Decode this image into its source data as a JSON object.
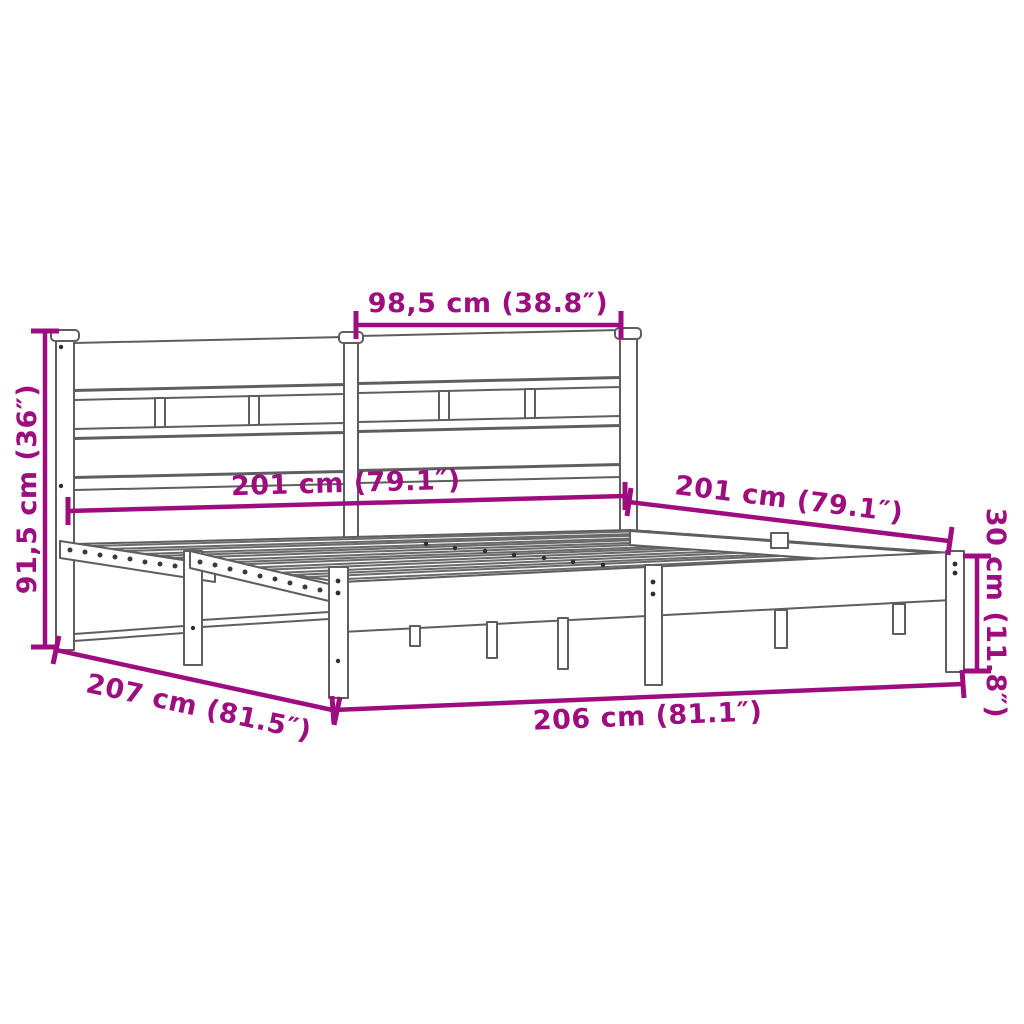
{
  "diagram": {
    "kind": "product-dimension-diagram",
    "subject": "metal bed frame with headboard",
    "background": "#ffffff",
    "accent_color": "#9e0d7f",
    "line_color": "#5e5e5e"
  },
  "dims": {
    "headboard_section_width": "98,5 cm (38.8″)",
    "headboard_height": "91,5 cm (36″)",
    "width_inner": "201 cm (79.1″)",
    "length_inner": "201 cm (79.1″)",
    "frame_height": "30 cm (11.8″)",
    "length_outer": "207 cm (81.5″)",
    "width_outer": "206 cm (81.1″)"
  }
}
